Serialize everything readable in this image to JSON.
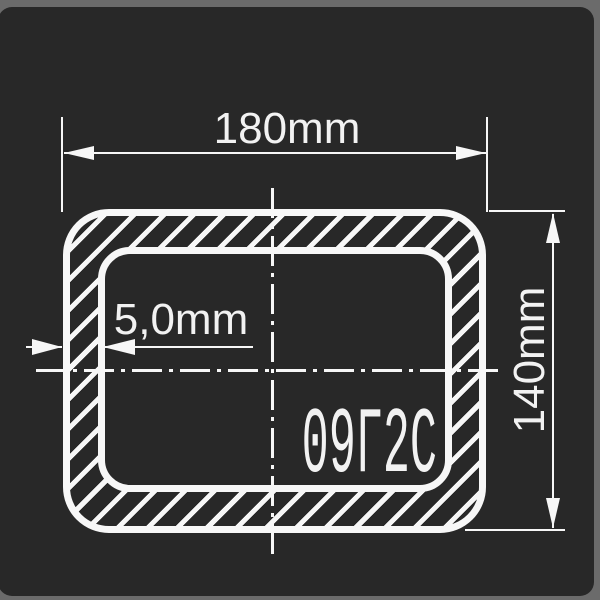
{
  "meta": {
    "type": "technical-drawing",
    "subject": "rectangular steel tube cross-section with hatched walls, center lines and dimensions"
  },
  "labels": {
    "width": "180mm",
    "height": "140mm",
    "wall_thickness": "5,0mm",
    "steel_grade": "09Г2С"
  },
  "colors": {
    "frame": "#6b6b6b",
    "background": "#282828",
    "line": "#f7f7f7"
  }
}
